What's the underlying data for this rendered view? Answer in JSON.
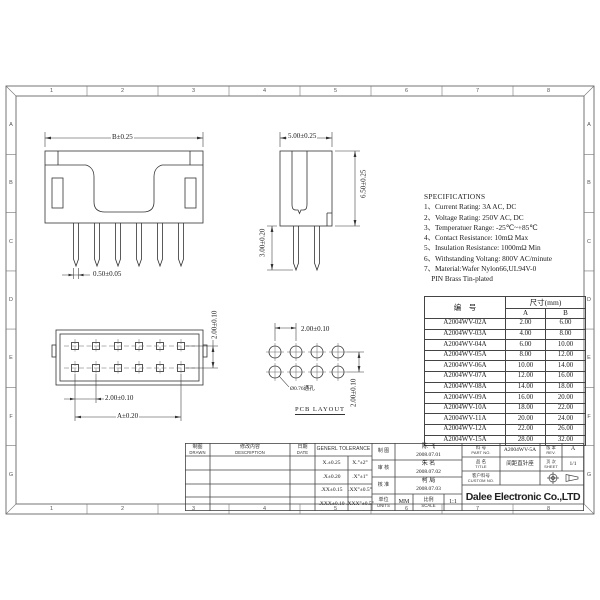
{
  "sheet": {
    "zone_numbers": [
      "1",
      "2",
      "3",
      "4",
      "5",
      "6",
      "7",
      "8"
    ],
    "zone_letters": [
      "A",
      "B",
      "C",
      "D",
      "E",
      "F",
      "G"
    ]
  },
  "specifications": {
    "title": "SPECIFICATIONS",
    "lines": [
      "1、Current Rating: 3A AC, DC",
      "2、Voltage Rating: 250V AC, DC",
      "3、Temperatuer Range: -25℃~+85℃",
      "4、Contact Resistance: 10mΩ Max",
      "5、Insulation Resistance: 1000mΩ Min",
      "6、Withstanding Voltang: 800V AC/minute",
      "7、Material:Wafer Nylon66,UL94V-0",
      "    PIN Brass Tin-plated"
    ]
  },
  "dims": {
    "front_width": "B±0.25",
    "front_pin_width": "0.50±0.05",
    "side_width": "5.00±0.25",
    "side_height": "6.50±0.25",
    "side_pin_length": "3.00±0.20",
    "top_row_pitch": "2.00±0.10",
    "top_col_pitch": "2.00±0.10",
    "top_span": "A±0.20",
    "pcb_col_pitch": "2.00±0.10",
    "pcb_row_pitch": "2.00±0.10",
    "pcb_hole_note": "Ø0.76通孔",
    "pcb_caption": "PCB LAYOUT"
  },
  "parts_table": {
    "col_part": "编　号",
    "col_size": "尺寸(mm)",
    "col_a": "A",
    "col_b": "B",
    "rows": [
      [
        "A2004WV-02A",
        "2.00",
        "6.00"
      ],
      [
        "A2004WV-03A",
        "4.00",
        "8.00"
      ],
      [
        "A2004WV-04A",
        "6.00",
        "10.00"
      ],
      [
        "A2004WV-05A",
        "8.00",
        "12.00"
      ],
      [
        "A2004WV-06A",
        "10.00",
        "14.00"
      ],
      [
        "A2004WV-07A",
        "12.00",
        "16.00"
      ],
      [
        "A2004WV-08A",
        "14.00",
        "18.00"
      ],
      [
        "A2004WV-09A",
        "16.00",
        "20.00"
      ],
      [
        "A2004WV-10A",
        "18.00",
        "22.00"
      ],
      [
        "A2004WV-11A",
        "20.00",
        "24.00"
      ],
      [
        "A2004WV-12A",
        "22.00",
        "26.00"
      ],
      [
        "A2004WV-15A",
        "28.00",
        "32.00"
      ]
    ]
  },
  "title_block": {
    "drawn_cn": "制图",
    "drawn_en": "DRAWN",
    "description_cn": "修改内容",
    "description_en": "DESCRIPTION",
    "date_cn": "日期",
    "date_en": "DATE",
    "tolerance_header": "GENERL TOLERANCE",
    "tolerances": [
      [
        "X.±0.25",
        "X.°±2°"
      ],
      [
        ".X±0.20",
        ".X°±1°"
      ],
      [
        ".XX±0.15",
        ".XX°±0.5°"
      ],
      [
        ".XXX±0.10",
        ".XXX°±0.5°"
      ]
    ],
    "sign_drawn": "制 图",
    "sign_checked": "审 核",
    "sign_approved": "核 准",
    "units_cn": "单位",
    "units_en": "UNITS",
    "units_value": "MM",
    "scale_cn": "比例",
    "scale_en": "SCALE",
    "scale_value": "1:1",
    "signoffs": [
      {
        "name": "陈 飞",
        "date": "2008.07.01"
      },
      {
        "name": "朱 名",
        "date": "2008.07.02"
      },
      {
        "name": "柯 局",
        "date": "2008.07.03"
      }
    ],
    "part_no_cn": "料 号",
    "part_no_en": "PART NO.",
    "part_no": "A2004WV-5A",
    "title_cn": "品 名",
    "title_en": "TITLE",
    "title_value": "间距直针座",
    "custom_cn": "客户料号",
    "custom_en": "CUSTOM NO.",
    "custom_value": "",
    "rev_cn": "版 本",
    "rev_en": "REV.",
    "rev_value": "A",
    "sheet_cn": "页 次",
    "sheet_en": "SHEET",
    "sheet_value": "1/1",
    "company": "Dalee Electronic Co.,LTD"
  }
}
